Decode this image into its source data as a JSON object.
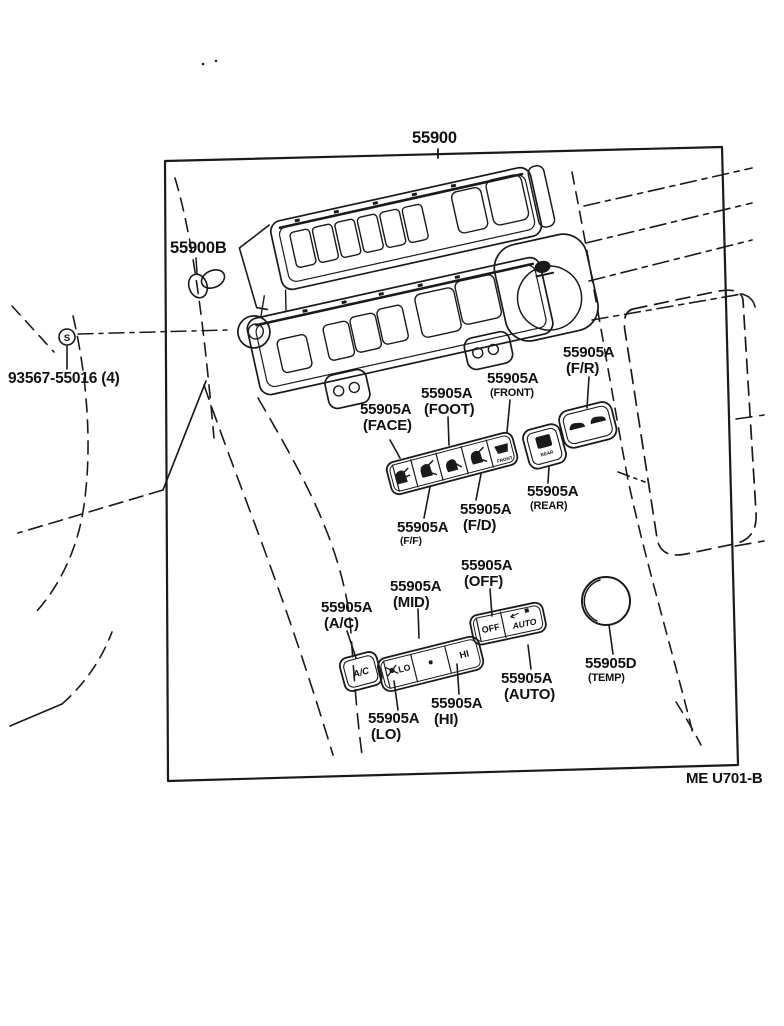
{
  "diagram": {
    "main_part": "55900",
    "clip_part": "55900B",
    "screw_part": "93567-55016 (4)",
    "screw_symbol": "S",
    "footer_code": "ME U701-B"
  },
  "labels": {
    "face": {
      "number": "55905A",
      "variant": "(FACE)"
    },
    "foot": {
      "number": "55905A",
      "variant": "(FOOT)"
    },
    "front": {
      "number": "55905A",
      "variant": "(FRONT)"
    },
    "fr": {
      "number": "55905A",
      "variant": "(F/R)"
    },
    "rear": {
      "number": "55905A",
      "variant": "(REAR)"
    },
    "fd": {
      "number": "55905A",
      "variant": "(F/D)"
    },
    "ff": {
      "number": "55905A",
      "variant": "(F/F)"
    },
    "ac": {
      "number": "55905A",
      "variant": "(A/C)"
    },
    "mid": {
      "number": "55905A",
      "variant": "(MID)"
    },
    "off": {
      "number": "55905A",
      "variant": "(OFF)"
    },
    "hi": {
      "number": "55905A",
      "variant": "(HI)"
    },
    "lo": {
      "number": "55905A",
      "variant": "(LO)"
    },
    "auto": {
      "number": "55905A",
      "variant": "(AUTO)"
    },
    "temp": {
      "number": "55905D",
      "variant": "(TEMP)"
    }
  },
  "buttons": {
    "ac": "A/C",
    "lo": "LO",
    "hi": "HI",
    "off": "OFF",
    "auto": "AUTO",
    "front": "FRONT",
    "rear": "REAR"
  },
  "icons": {
    "mode_face": "face-airflow",
    "mode_bilevel": "bilevel-airflow",
    "mode_foot": "foot-airflow",
    "mode_foot_defrost": "foot-defrost-airflow",
    "mode_front_defrost": "front-defrost",
    "rear_defrost": "rear-defrost",
    "recirc_fresh": "car-recirculate-fresh",
    "fan": "fan-blower",
    "screw": "screw-symbol"
  },
  "colors": {
    "ink": "#1a1a1a",
    "paper": "#ffffff"
  }
}
